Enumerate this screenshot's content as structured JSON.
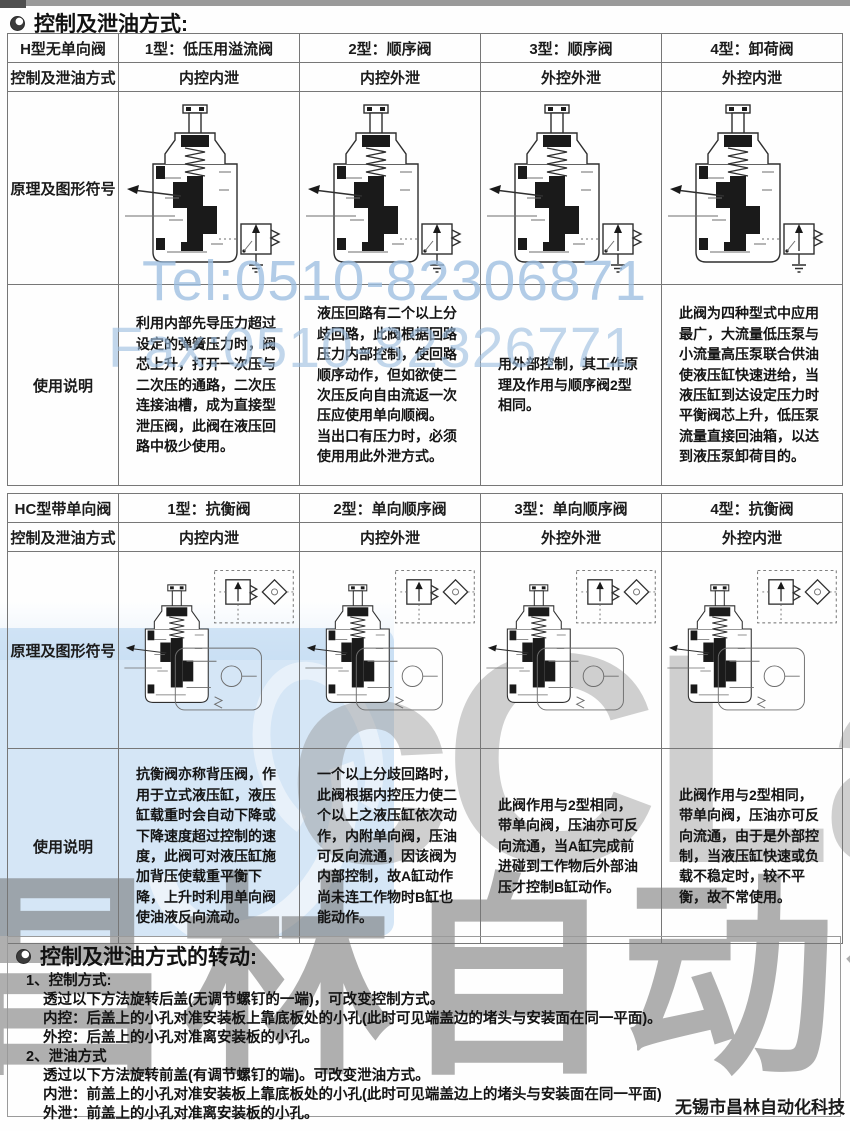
{
  "titles": {
    "section1": "控制及泄油方式:",
    "section2": "控制及泄油方式的转动:"
  },
  "table_h": {
    "corner": "H型无单向阀",
    "mode_label": "控制及泄油方式",
    "diagram_label": "原理及图形符号",
    "usage_label": "使用说明",
    "types": [
      "1型：低压用溢流阀",
      "2型：顺序阀",
      "3型：顺序阀",
      "4型：卸荷阀"
    ],
    "modes": [
      "内控内泄",
      "内控外泄",
      "外控外泄",
      "外控内泄"
    ],
    "usage": [
      "利用内部先导压力超过设定的弹簧压力时，阀芯上升，打开一次压与二次压的通路，二次压连接油槽，成为直接型泄压阀，此阀在液压回路中极少使用。",
      "液压回路有二个以上分歧回路，此阀根据回路压力内部控制，使回路顺序动作，但如欲使二次压反向自由流返一次压应使用单向顺阀。\n当出口有压力时，必须使用用此外泄方式。",
      "用外部控制，其工作原理及作用与顺序阀2型相同。",
      "此阀为四种型式中应用最广，大流量低压泵与小流量高压泵联合供油使液压缸快速进给，当液压缸到达设定压力时平衡阀芯上升，低压泵流量直接回油箱，以达到液压泵卸荷目的。"
    ]
  },
  "table_hc": {
    "corner": "HC型带单向阀",
    "mode_label": "控制及泄油方式",
    "diagram_label": "原理及图形符号",
    "usage_label": "使用说明",
    "types": [
      "1型：抗衡阀",
      "2型：单向顺序阀",
      "3型：单向顺序阀",
      "4型：抗衡阀"
    ],
    "modes": [
      "内控内泄",
      "内控外泄",
      "外控外泄",
      "外控内泄"
    ],
    "usage": [
      "抗衡阀亦称背压阀，作用于立式液压缸，液压缸载重时会自动下降或下降速度超过控制的速度，此阀可对液压缸施加背压使载重平衡下降，上升时利用单向阀使油液反向流动。",
      "一个以上分歧回路时，此阀根据内控压力使二个以上之液压缸依次动作，内附单向阀，压油可反向流通，因该阀为内部控制，故A缸动作尚未连工作物时B缸也能动作。",
      "此阀作用与2型相同，带单向阀，压油亦可反向流通，当A缸完成前进碰到工作物后外部油压才控制B缸动作。",
      "此阀作用与2型相同，带单向阀，压油亦可反向流通，由于是外部控制，当液压缸快速或负载不稳定时，较不平衡，故不常使用。"
    ]
  },
  "bottom": {
    "item1_no": "1、",
    "item1_title": "控制方式:",
    "item1_lines": [
      "透过以下方法旋转后盖(无调节螺钉的一端)，可改变控制方式。",
      "内控：后盖上的小孔对准安装板上靠底板处的小孔(此时可见端盖边的堵头与安装面在同一平面)。",
      "外控：后盖上的小孔对准离安装板的小孔。"
    ],
    "item2_no": "2、",
    "item2_title": "泄油方式",
    "item2_lines": [
      "透过以下方法旋转前盖(有调节螺钉的端)。可改变泄油方式。",
      "内泄：前盖上的小孔对准安装板上靠底板处的小孔(此时可见端盖边上的堵头与安装面在同一平面)",
      "外泄：前盖上的小孔对准离安装板的小孔。"
    ]
  },
  "watermarks": {
    "tel": "Tel:0510-82306871",
    "fax": "Fax:0510-82326771",
    "brand_latin": "cCLair",
    "brand_cn": "昌林自动化",
    "blue_color": "#9dbfe1",
    "gray_color": "#8f8f8f",
    "dark_color": "#6f6f6f"
  },
  "footer": {
    "company": "无锡市昌林自动化科技"
  }
}
